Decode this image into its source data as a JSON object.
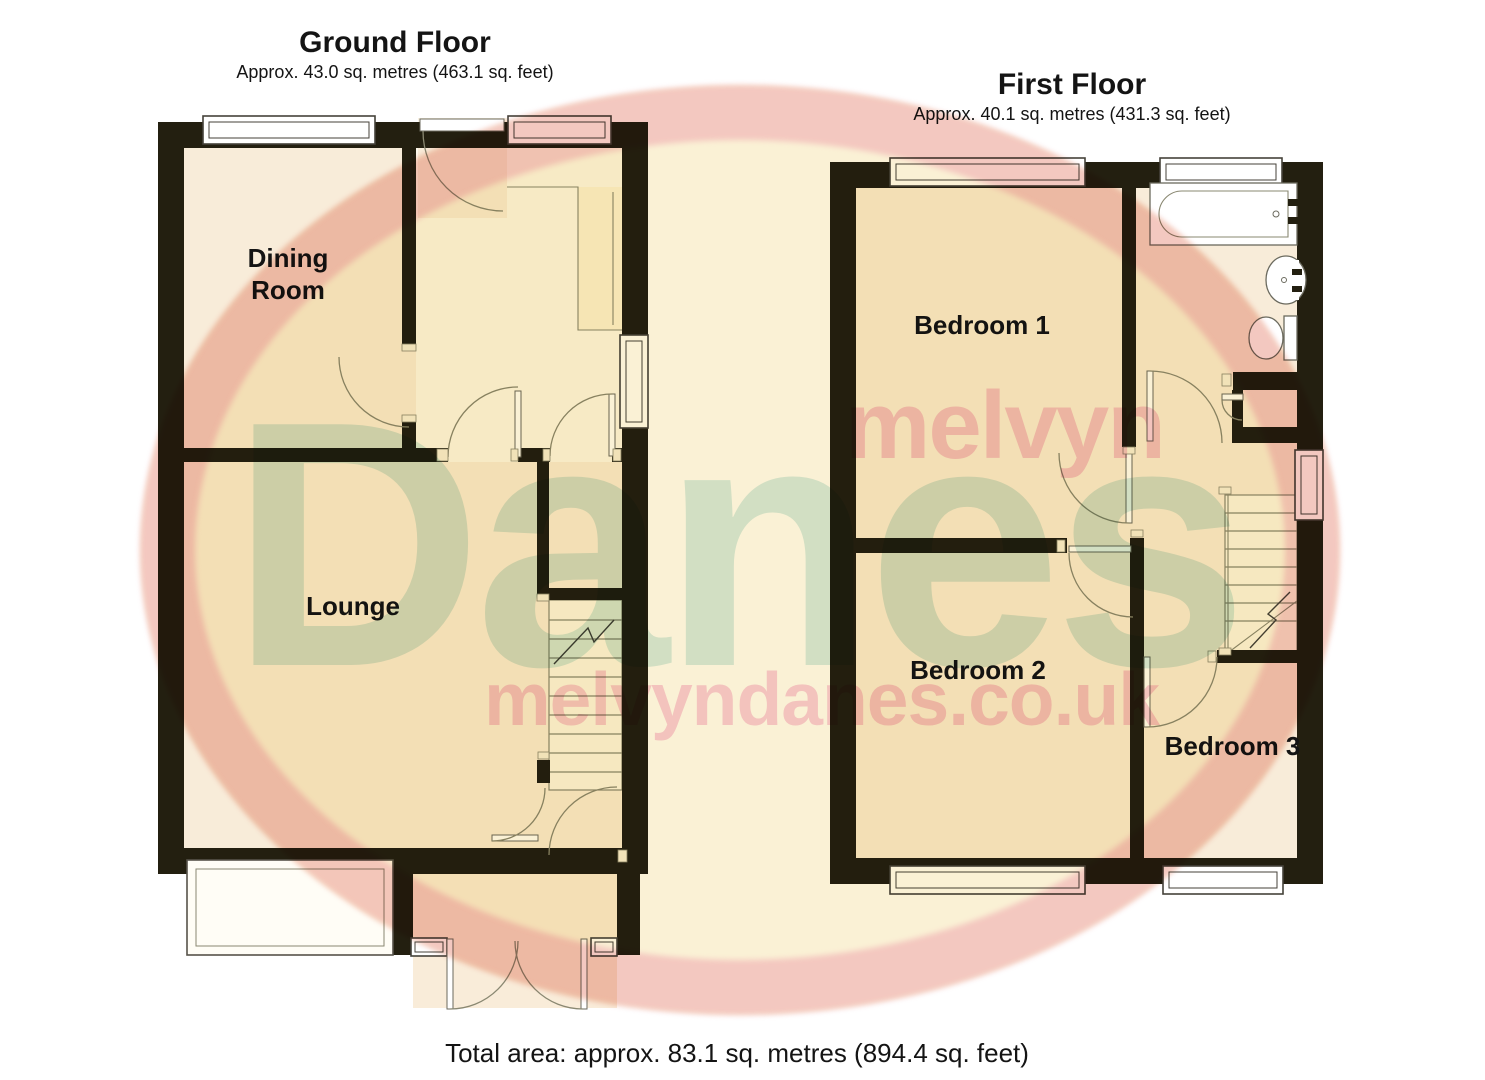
{
  "ground_floor": {
    "title": "Ground Floor",
    "subtitle": "Approx. 43.0 sq. metres (463.1 sq. feet)",
    "rooms": {
      "dining_room": "Dining Room",
      "lounge": "Lounge"
    }
  },
  "first_floor": {
    "title": "First Floor",
    "subtitle": "Approx. 40.1 sq. metres (431.3 sq. feet)",
    "rooms": {
      "bedroom_1": "Bedroom 1",
      "bedroom_2": "Bedroom 2",
      "bedroom_3": "Bedroom 3"
    }
  },
  "footer": {
    "total_area": "Total area: approx. 83.1 sq. metres (894.4 sq. feet)"
  },
  "watermark": {
    "word_top": "melvyn",
    "word_main": "Danes",
    "url": "melvyndanes.co.uk"
  },
  "icons": [
    "bath-icon",
    "sink-icon",
    "toilet-icon",
    "stairs-up-icon",
    "window-icon",
    "door-swing-icon"
  ],
  "colors": {
    "wall": "#231f10",
    "floor_cream": "#f8ecd9",
    "floor_white": "#fcf8ec",
    "stair_fill": "#fbf6e6",
    "outline": "#8a8872",
    "frame": "#45423a",
    "wm_pink": "#ec96a6",
    "wm_green": "#9cc6ab",
    "wm_yellow": "#f2dc96",
    "text": "#141414"
  }
}
